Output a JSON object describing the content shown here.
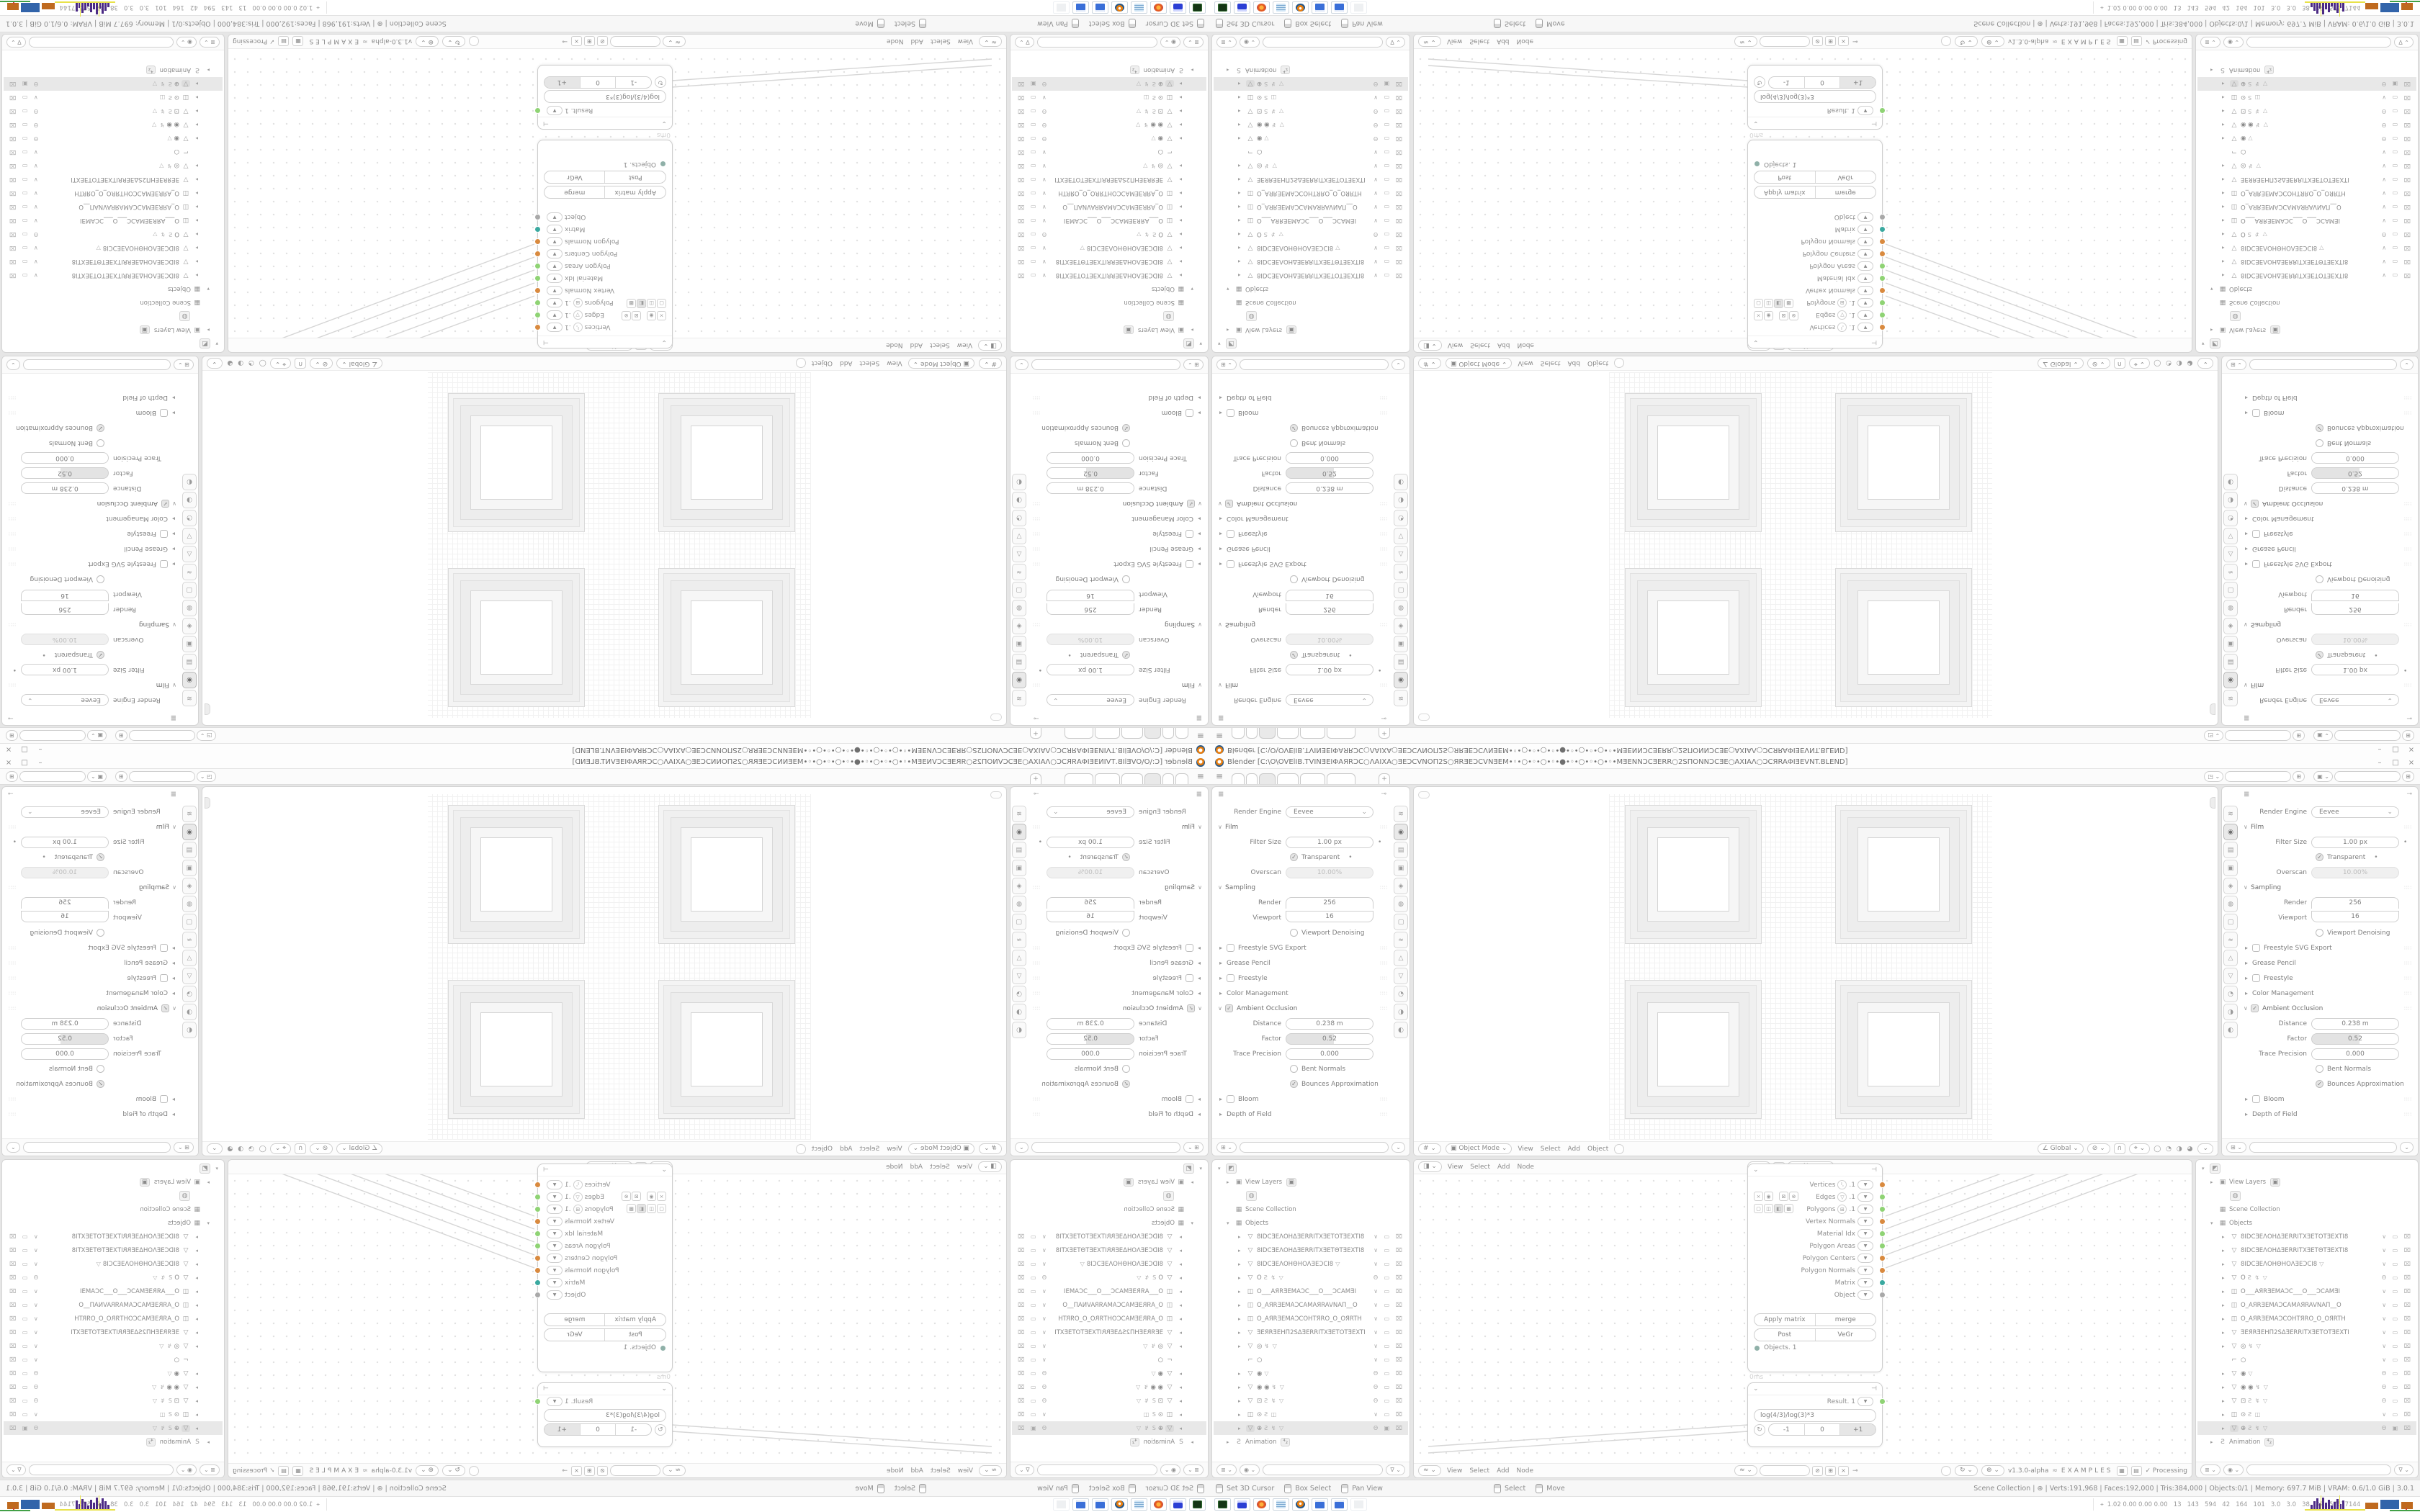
{
  "palette": {
    "area_bg": "#ffffff",
    "gap_bg": "#e6e6e6",
    "border": "#d4d4d4",
    "text": "#7d7d7d",
    "accent_orange": "#e87d0d",
    "socket_orange": "#d98a3f",
    "socket_green": "#8fd374",
    "socket_teal": "#3aa9a0",
    "socket_gray": "#a9a9a9",
    "hist_purple": "#4b2a85",
    "hist_yellow": "#e8e24a"
  },
  "window": {
    "title": "Blender [C:\\O\\OVElIB.TVINƎEIΦAЯRƆC○ΛAIXA○ƎEƆCVNOΠ2S○ЯRƎEƆCVNƎEM•◦•○•◦•○•◦•●•◦•○•◦•○•◦•MƎENNƆCƎERR○2SΠONNƆCƎE○AXIAΛ○ƆCЯRAΦIƎEVNT.BLEND]",
    "min": "–",
    "max": "□",
    "close": "×"
  },
  "topbar": {
    "menu": "≡",
    "plus": "+",
    "tabs": [
      {
        "c": "ws-tab t1"
      },
      {
        "c": "ws-tab t2"
      },
      {
        "c": "ws-tab t3 active"
      },
      {
        "c": "ws-tab t4"
      },
      {
        "c": "ws-tab t5"
      },
      {
        "c": "ws-tab t6"
      }
    ],
    "scene": {
      "icon": "◳ ⌄",
      "value": "",
      "copy": "⊞"
    },
    "view_layer": {
      "icon": "▣ ⌄",
      "value": "",
      "copy": "⊞"
    }
  },
  "properties": {
    "icon": "≣",
    "pin": "⊸",
    "tabs": [
      {
        "c": "p-tab",
        "v": "≋"
      },
      {
        "c": "p-tab active",
        "v": "◉"
      },
      {
        "c": "p-tab",
        "v": "▤"
      },
      {
        "c": "p-tab",
        "v": "▣"
      },
      {
        "c": "p-tab",
        "v": "◈"
      },
      {
        "c": "p-tab",
        "v": "◍"
      },
      {
        "c": "p-tab",
        "v": "▢"
      },
      {
        "c": "p-tab",
        "v": "≈"
      },
      {
        "c": "p-tab",
        "v": "△"
      },
      {
        "c": "p-tab",
        "v": "▽"
      },
      {
        "c": "p-tab",
        "v": "◔"
      },
      {
        "c": "p-tab",
        "v": "◑"
      },
      {
        "c": "p-tab",
        "v": "◐"
      }
    ],
    "rows": [
      {
        "cls": "prow",
        "k": "Render Engine",
        "v": "Eevee",
        "c": "ctl sel"
      },
      {
        "cls": "prow sec",
        "caret": "∨",
        "k": "Film",
        "grip": "∷∷"
      },
      {
        "cls": "prow",
        "k": "Filter Size",
        "v": "1.00 px",
        "c": "ctl pill",
        "dot": "•"
      },
      {
        "cls": "prow chk",
        "chk": "on",
        "k": "Transparent",
        "dot": "•"
      },
      {
        "cls": "prow",
        "k": "Overscan",
        "v": "10.00%",
        "c": "ctl pill dis"
      },
      {
        "cls": "prow sec",
        "caret": "∨",
        "k": "Sampling",
        "grip": "∷∷"
      },
      {
        "cls": "prow",
        "k": "Render",
        "v": "256",
        "c": "ctl num ntop"
      },
      {
        "cls": "prow",
        "k": "Viewport",
        "v": "16",
        "c": "ctl num nbot"
      },
      {
        "cls": "prow chk",
        "chk": "off",
        "k": "Viewport Denoising"
      },
      {
        "cls": "prow sec2",
        "caret": "▸",
        "chk": "off",
        "k": "Freestyle SVG Export",
        "grip": "∷∷"
      },
      {
        "cls": "prow sec2",
        "caret": "▸",
        "k": "Grease Pencil",
        "grip": "∷∷"
      },
      {
        "cls": "prow sec2",
        "caret": "▸",
        "chk": "off",
        "k": "Freestyle",
        "grip": "∷∷"
      },
      {
        "cls": "prow sec2",
        "caret": "▸",
        "k": "Color Management",
        "grip": "∷∷"
      },
      {
        "cls": "prow sec",
        "caret": "∨",
        "chk": "on",
        "k": "Ambient Occlusion",
        "grip": "∷∷"
      },
      {
        "cls": "prow",
        "k": "Distance",
        "v": "0.238 m",
        "c": "ctl pill"
      },
      {
        "cls": "prow",
        "k": "Factor",
        "v": "0.52",
        "c": "ctl pill half"
      },
      {
        "cls": "prow",
        "k": "Trace Precision",
        "v": "0.000",
        "c": "ctl pill"
      },
      {
        "cls": "prow chk",
        "chk": "off",
        "k": "Bent Normals"
      },
      {
        "cls": "prow chk",
        "chk": "on",
        "k": "Bounces Approximation"
      },
      {
        "cls": "prow sec2",
        "caret": "▸",
        "chk": "off",
        "k": "Bloom",
        "grip": "∷∷"
      },
      {
        "cls": "prow sec2",
        "caret": "▸",
        "k": "Depth of Field",
        "grip": "∷∷"
      }
    ],
    "search": {
      "icon": "⊞ ⌄",
      "value": "",
      "filter": "⌄"
    }
  },
  "outliner": {
    "rows": [
      {
        "cls": "orow",
        "caret": "▾",
        "icon": "◩",
        "icls": "oi obx"
      },
      {
        "cls": "orow ind1",
        "caret": "▸",
        "icon": "▣",
        "icls": "oi",
        "name": "View Layers",
        "badge": "▣"
      },
      {
        "cls": "orow ind2",
        "icon": "◍",
        "icls": "oi obx"
      },
      {
        "cls": "orow ind1",
        "icon": "▦",
        "icls": "oi",
        "name": "Scene Collection"
      },
      {
        "cls": "orow ind1",
        "caret": "▾",
        "icon": "▦",
        "icls": "oi",
        "name": "Objects"
      },
      {
        "cls": "orow ind2",
        "caret": "▸",
        "icon": "▽",
        "icls": "oi",
        "name": "8IDCƎEΛOHΔƎERRITXƎETOTƎEXTI8",
        "tog": "∨ ▭ ⌧"
      },
      {
        "cls": "orow ind2",
        "caret": "▸",
        "icon": "▽",
        "icls": "oi",
        "name": "8IDCƎEΛOHΔƎERRITXƎETΘTƎEXTI8",
        "tog": "∨ ▭ ⌧"
      },
      {
        "cls": "orow ind2",
        "caret": "▸",
        "icon": "▽",
        "icls": "oi",
        "name": "8IDCƎEΛOHΘHOΛƎEƆCI8",
        "extra": "▽",
        "tog": "∨ ▭ ⌧"
      },
      {
        "cls": "orow ind2",
        "caret": "▸",
        "icon": "▽",
        "icls": "oi",
        "name": "O",
        "extra": "Ƨ ↯ ▽",
        "tog": "Θ ▭ ⌧"
      },
      {
        "cls": "orow ind2",
        "caret": "▸",
        "icon": "◫",
        "icls": "oi",
        "name": "O___AЯRƎEMAƆC___O___ƆCAMƎI",
        "tog": "∨ ▭ ⌧"
      },
      {
        "cls": "orow ind2",
        "caret": "▸",
        "icon": "◫",
        "icls": "oi",
        "name": "O_AЯRƎEMAƆCAMAЯRAVNAΠ__O",
        "tog": "∨ ▭ ⌧"
      },
      {
        "cls": "orow ind2",
        "caret": "▸",
        "icon": "◫",
        "icls": "oi",
        "name": "O_AЯRƎEMAƆCOHTЯRO_O_OЯRTH",
        "tog": "∨ ▭ ⌧"
      },
      {
        "cls": "orow ind2",
        "caret": "▸",
        "icon": "▽",
        "icls": "oi",
        "name": "ƎEЯRƎEHΠ2SΔƎERRITXƎETOTƎEXTI",
        "tog": "∨ ▭ ⌧"
      },
      {
        "cls": "orow ind2",
        "caret": "▸",
        "icon": "▽",
        "icls": "oi",
        "name": "◎",
        "extra": "↯ ▽",
        "tog": "∨ ▭ ⌧"
      },
      {
        "cls": "orow ind2",
        "icon": "⌐",
        "icls": "oi",
        "name": "○",
        "tog": "∨ ▭ ⌧"
      },
      {
        "cls": "orow ind2",
        "caret": "▸",
        "icon": "▽",
        "icls": "oi",
        "name": "◉",
        "extra": "▽",
        "tog": "Θ ▭ ⌧"
      },
      {
        "cls": "orow ind2",
        "caret": "▸",
        "icon": "▽",
        "icls": "oi",
        "name": "◉ ◉",
        "extra": "↯ ▽",
        "tog": "Θ ▭ ⌧"
      },
      {
        "cls": "orow ind2",
        "caret": "▸",
        "icon": "▽",
        "icls": "oi",
        "name": "⊡",
        "extra": "Ƨ ↯ ▽",
        "tog": "Θ ▭ ⌧"
      },
      {
        "cls": "orow ind2",
        "caret": "▸",
        "icon": "◫",
        "icls": "oi",
        "name": "⊙",
        "extra": "Ƨ ◫",
        "tog": "∨ ▭ ⌧"
      },
      {
        "cls": "orow ind2 sel",
        "caret": "▸",
        "icon": "▽",
        "icls": "oi osel",
        "name": "⊕",
        "extra": "Ƨ ↯ ▽",
        "tog": "Θ ▣ ⌧"
      },
      {
        "cls": "orow ind1",
        "caret": "▸",
        "icon": "Ƨ",
        "icls": "oi",
        "name": "Animation",
        "badge": "⁴₂"
      }
    ],
    "footer": {
      "mode": "≣ ⌄",
      "display": "◉ ⌄",
      "search": "",
      "filter": "∇ ⌄"
    }
  },
  "viewport": {
    "hdr_left": [
      {
        "c": "vh-ic",
        "v": "# ⌄"
      },
      {
        "c": "vh-pill",
        "v": "▣ Object Mode ⌄"
      },
      {
        "c": "vh-m",
        "v": "View"
      },
      {
        "c": "vh-m",
        "v": "Select"
      },
      {
        "c": "vh-m",
        "v": "Add"
      },
      {
        "c": "vh-m",
        "v": "Object"
      },
      {
        "c": "vh-circ",
        "v": ""
      }
    ],
    "hdr_right": [
      {
        "c": "vh-pill",
        "v": "∠ Global ⌄"
      },
      {
        "c": "vh-pill",
        "v": "⊘ ⌄"
      },
      {
        "c": "vh-sq",
        "v": "∩"
      },
      {
        "c": "vh-pill",
        "v": "⌖ ⌄"
      },
      {
        "c": "vh-sh",
        "v": "◯ ◔ ◑ ◕"
      },
      {
        "c": "vh-pill",
        "v": "⌄"
      }
    ]
  },
  "node_editor": {
    "top_left": [
      {
        "c": "vh-ic",
        "v": "◨ ⌄"
      },
      {
        "c": "vh-m",
        "v": "View"
      },
      {
        "c": "vh-m",
        "v": "Select"
      },
      {
        "c": "vh-m",
        "v": "Add"
      },
      {
        "c": "vh-m",
        "v": "Node"
      }
    ],
    "top_mid": [
      {
        "c": "vh-ic",
        "v": "◨ ⌄"
      },
      {
        "c": "nb-box",
        "v": "1"
      },
      {
        "c": "nb-new",
        "v": "New"
      },
      {
        "c": "vh-m",
        "v": "⊸"
      }
    ],
    "bot_left": [
      {
        "c": "vh-ic",
        "v": "≈ ⌄"
      },
      {
        "c": "vh-m",
        "v": "View"
      },
      {
        "c": "vh-m",
        "v": "Select"
      },
      {
        "c": "vh-m",
        "v": "Add"
      },
      {
        "c": "vh-m",
        "v": "Node"
      }
    ],
    "bot_mid": [
      {
        "c": "vh-ic",
        "v": "≈ ⌄"
      },
      {
        "c": "nb-field",
        "v": ""
      },
      {
        "c": "nb-sq",
        "v": "⊘"
      },
      {
        "c": "nb-sq",
        "v": "⊞"
      },
      {
        "c": "nb-sq",
        "v": "×"
      },
      {
        "c": "vh-m",
        "v": "⊸"
      }
    ],
    "bot_right": [
      {
        "c": "vh-circ",
        "v": ""
      },
      {
        "c": "vh-pill",
        "v": "↻ ⌄"
      },
      {
        "c": "vh-pill",
        "v": "⊕ ⌄"
      },
      {
        "c": "nb-ver",
        "v": "v1.3.0-alpha"
      },
      {
        "c": "nb-dna",
        "v": "≈"
      },
      {
        "c": "nb-ex",
        "v": "EXAMPLES"
      },
      {
        "c": "nb-sq",
        "v": "▦"
      },
      {
        "c": "nb-sq",
        "v": "▤"
      },
      {
        "c": "nb-proc",
        "v": "✓ Processing"
      }
    ],
    "node_main": {
      "collapse": "⌄",
      "hicon": "⊣",
      "sockets": [
        {
          "l": "Vertices",
          "ic": "⠣",
          "n": ".1",
          "col": "#d98a3f"
        },
        {
          "l": "Edges",
          "ic": "▽",
          "n": ".1",
          "col": "#8fd374"
        },
        {
          "l": "Polygons",
          "ic": "⊞",
          "n": ".1",
          "col": "#8fd374"
        },
        {
          "l": "Vertex Normals",
          "col": "#d98a3f"
        },
        {
          "l": "Material Idx",
          "col": "#8fd374"
        },
        {
          "l": "Polygon Areas",
          "col": "#8fd374"
        },
        {
          "l": "Polygon Centers",
          "col": "#d98a3f"
        },
        {
          "l": "Polygon Normals",
          "col": "#d98a3f"
        },
        {
          "l": "Matrix",
          "col": "#3aa9a0"
        },
        {
          "l": "Object",
          "col": "#a9a9a9"
        }
      ],
      "tools1": [
        "×",
        "◉"
      ],
      "tools2": [
        "⊠",
        "⊗"
      ],
      "display": [
        {
          "c": "",
          "v": "▢"
        },
        {
          "c": "",
          "v": "◫"
        },
        {
          "c": "on",
          "v": "◧"
        },
        {
          "c": "",
          "v": "▩"
        }
      ],
      "btn_row1": [
        "Apply matrix",
        "merge"
      ],
      "btn_row2": [
        "Post",
        "VeGr"
      ],
      "input": {
        "label": "Objects. 1",
        "col": "#8fb0a8"
      },
      "time": "0ms"
    },
    "node_formula": {
      "collapse": "⌄",
      "hicon": "⊣",
      "result": {
        "label": "Result. 1",
        "col": "#8fd374"
      },
      "expr": "log(4/3)/log(3)*3",
      "refresh": "↻",
      "seg": [
        {
          "c": "",
          "v": "-1"
        },
        {
          "c": "",
          "v": "0"
        },
        {
          "c": "on",
          "v": "+1"
        }
      ]
    }
  },
  "statusbar": {
    "hints": [
      {
        "c": "hint",
        "v": "Set 3D Cursor"
      },
      {
        "c": "hint",
        "v": "Box Select"
      },
      {
        "c": "hint",
        "v": "Pan View"
      },
      {
        "c": "hint gap",
        "v": "Select"
      },
      {
        "c": "hint",
        "v": "Move"
      }
    ],
    "stats": "Scene Collection | ⊕ | Verts:191,968 | Faces:192,000 | Tris:384,000 | Objects:0/1 | Memory: 697.7 MiB | VRAM: 0.6/1.0 GiB | 3.0.1"
  },
  "taskbar": {
    "apps": [
      {
        "cls": "tile t1",
        "dn": "recorder-app-icon"
      },
      {
        "cls": "tile t2",
        "dn": "emulator-app-icon"
      },
      {
        "cls": "tile t3",
        "dn": "firefox-app-icon"
      },
      {
        "cls": "tile t4",
        "dn": "notepad-app-icon"
      },
      {
        "cls": "tile t5",
        "dn": "blender-app-icon"
      },
      {
        "cls": "tile t6",
        "dn": "calculator-app-icon"
      },
      {
        "cls": "tile t6",
        "dn": "calculator-2-app-icon"
      },
      {
        "cls": "tile t8",
        "dn": "inactive-app-icon"
      }
    ],
    "monitor": {
      "icon": "⌖",
      "text": "1.02 0.00 0.00 0.00   13   143   594   42   164   101   3.0   3.0   38   32   57677144"
    },
    "histogram": {
      "bars": [
        6,
        11,
        15,
        8,
        16,
        9,
        13,
        5,
        10,
        14,
        7,
        12
      ]
    },
    "blocks": [
      {
        "c": "#bf6a1f",
        "s": "width:18px;height:9px"
      },
      {
        "c": "#3264aa",
        "s": "width:26px;height:13px"
      },
      {
        "c": "#bf6a1f",
        "s": "width:16px;height:10px"
      }
    ]
  }
}
